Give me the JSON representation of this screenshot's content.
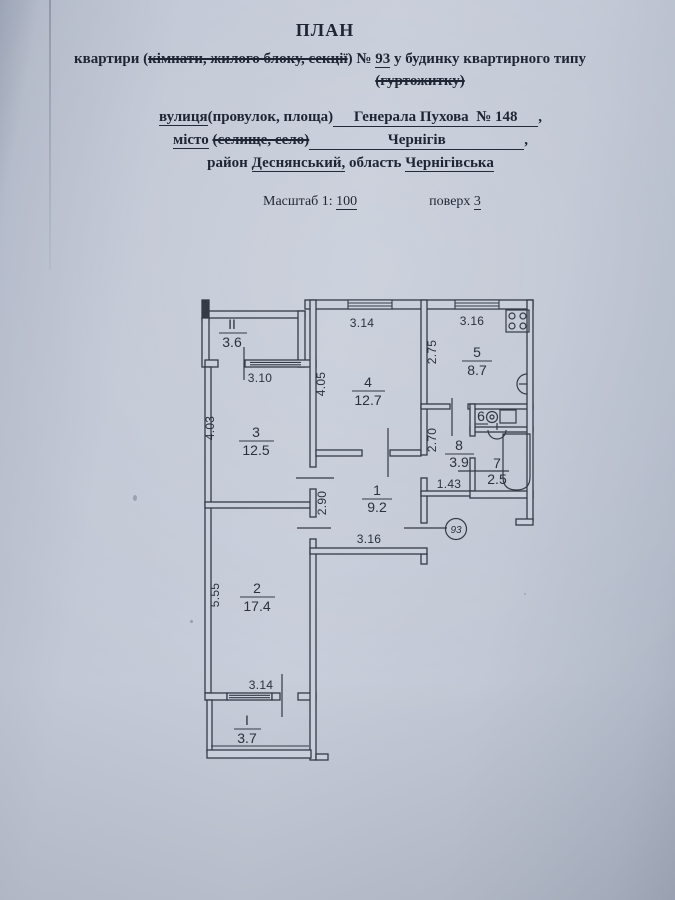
{
  "document": {
    "title": "ПЛАН",
    "subject": {
      "prefix": "квартири (",
      "struck_options": "кімнати, жилого блоку, секції",
      "close_paren": ")",
      "number_sign": "№",
      "apartment_number": "93",
      "suffix": "у будинку квартирного типу",
      "struck_line2": "(гуртожитку)"
    },
    "address": {
      "street_label": "вулиця",
      "street_label_options": "(провулок, площа)",
      "street_value": "Генерала Пухова",
      "street_number_sign": "№",
      "street_number": "148",
      "street_comma": ",",
      "city_label": "місто",
      "city_struck_options": "(селище, село)",
      "city_value": "Чернігів",
      "city_comma": ",",
      "district_label": "район",
      "district_value": "Деснянський,",
      "region_label": "область",
      "region_value": "Чернігівська"
    },
    "meta": {
      "scale_label": "Масштаб 1:",
      "scale_value": "100",
      "floor_label": "поверх",
      "floor_value": "3"
    }
  },
  "plan": {
    "apartment_badge": "93",
    "rooms": {
      "balcony_top": {
        "num": "II",
        "area": "3.6"
      },
      "room4": {
        "num": "4",
        "area": "12.7"
      },
      "kitchen": {
        "num": "5",
        "area": "8.7"
      },
      "room3": {
        "num": "3",
        "area": "12.5"
      },
      "wc": {
        "num": "6",
        "area": ""
      },
      "corridor8": {
        "num": "8",
        "area": "3.9"
      },
      "bathroom": {
        "num": "7",
        "area": "2.5"
      },
      "hall": {
        "num": "1",
        "area": "9.2"
      },
      "room2": {
        "num": "2",
        "area": "17.4"
      },
      "balcony_bottom": {
        "num": "I",
        "area": "3.7"
      }
    },
    "dims": {
      "room4_top": "3.14",
      "kitchen_top": "3.16",
      "kitchen_left": "2.75",
      "room4_left": "4.05",
      "balcony_top_width": "3.10",
      "room3_left": "4.03",
      "corridor8_left": "2.70",
      "hall_left": "2.90",
      "corridor8_width": "1.43",
      "hall_bottom": "3.16",
      "room2_left": "5.55",
      "room2_bottom": "3.14"
    }
  }
}
